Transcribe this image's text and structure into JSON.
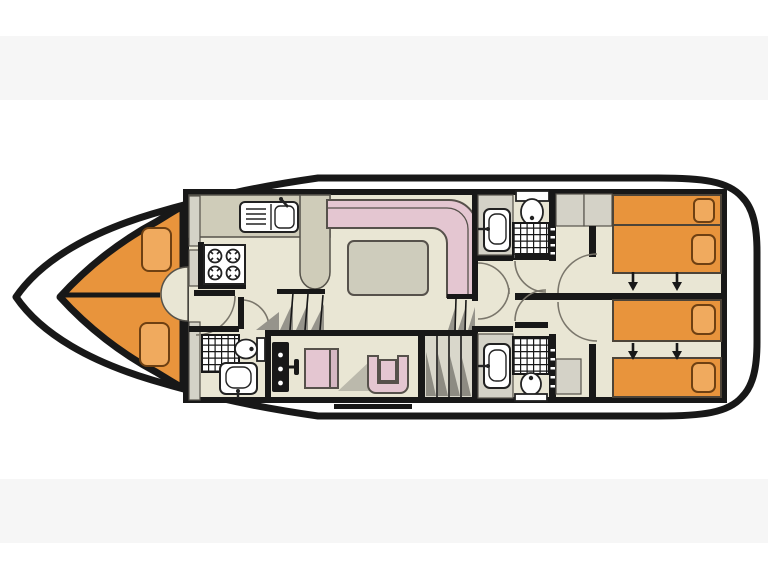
{
  "colors": {
    "page_bg": "#ffffff",
    "band_gray": "#f6f6f6",
    "wall_black": "#181818",
    "deck_white": "#ffffff",
    "floor_beige": "#E9E6D4",
    "cabin_orange": "#E8943C",
    "pillow_orange": "#F0AA5E",
    "pillow_edge": "#6E4012",
    "sofa_pink": "#E4C6D1",
    "seat_back_pink": "#D6B8C3",
    "counter_khaki": "#CFCCB9",
    "table_taupe": "#CECCBC",
    "cabinet_gray": "#D4D2C7",
    "shadow_gray": "#96948B",
    "shadow_dark": "#8D8B82",
    "steps_light": "#D9D7CB",
    "fixture_edge": "#222222",
    "furniture_edge": "#56514B",
    "outline_gray": "#55524A",
    "bed_edge": "#4D4438",
    "arc_gray": "#7A766B"
  },
  "plan": {
    "type": "boat-deck-floor-plan",
    "bow_direction": "left",
    "rooms": [
      {
        "name": "v-berth-cabin",
        "features": [
          "v-shaped-double-berth",
          "pillow",
          "pillow",
          "entry-door-arc"
        ]
      },
      {
        "name": "galley",
        "features": [
          "sink-with-drainer",
          "faucet",
          "stove-4-burners",
          "counter-peninsula",
          "cabinets"
        ]
      },
      {
        "name": "forward-bathroom",
        "features": [
          "shower",
          "toilet",
          "washbasin",
          "door-arc"
        ]
      },
      {
        "name": "saloon",
        "features": [
          "l-shaped-sofa",
          "dining-table",
          "steps-to-helm",
          "steps-to-aft"
        ]
      },
      {
        "name": "helm-station",
        "features": [
          "instrument-panel",
          "throttle-lever",
          "pilot-seat",
          "bucket-chair",
          "staircase"
        ]
      },
      {
        "name": "mid-bathroom-top",
        "features": [
          "washbasin",
          "toilet",
          "shower",
          "towel-rail",
          "door-arc"
        ]
      },
      {
        "name": "mid-bathroom-bottom",
        "features": [
          "washbasin",
          "toilet",
          "shower",
          "towel-rail",
          "door-arc"
        ]
      },
      {
        "name": "aft-cabin-top",
        "features": [
          "bed",
          "bed",
          "pillow",
          "pillow",
          "slide-arrows",
          "wardrobe",
          "door-arc"
        ]
      },
      {
        "name": "aft-cabin-bottom",
        "features": [
          "bed",
          "bed",
          "pillow",
          "pillow",
          "slide-arrows",
          "cabinet",
          "door-arc"
        ]
      }
    ],
    "counts": {
      "toilets": 3,
      "showers": 3,
      "washbasins": 3,
      "galley_sinks": 1,
      "stove_burners": 4,
      "aft_beds": 4,
      "slide_arrows": 4
    }
  }
}
